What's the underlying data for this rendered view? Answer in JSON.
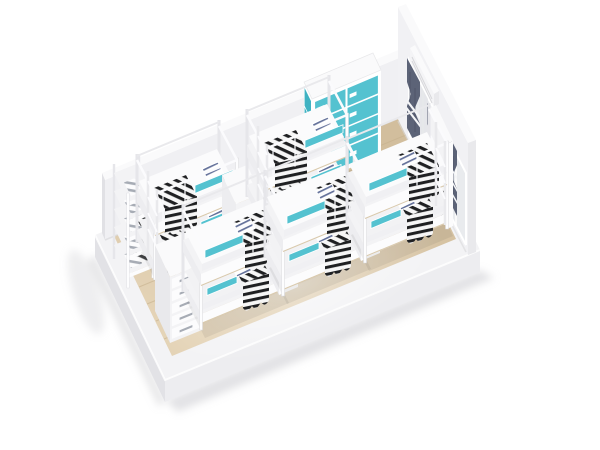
{
  "scene": {
    "title": "Dormitory room - isometric 3D render",
    "description": "Isometric 3D render of a white dormitory room displayed on a white plinth: two rows of white metal bunk beds with black-and-white striped blankets, navy striped pillows and teal safety rails, a teal-door locker cabinet, two windows with dark blue-grey tied curtains, a wall air conditioner, ladder shelf with folded bedding, a drawer rack, bedside cube shelves and a light wood plank floor."
  },
  "colors": {
    "bg": "#ffffff",
    "plinth-top": "#f3f3f5",
    "plinth-left": "#e2e2e6",
    "plinth-right": "#ededf0",
    "ground-shadow": "#c8c8cd",
    "floor-light": "#e4d3b6",
    "floor-dark": "#d2be9d",
    "plank": "#c6b18d",
    "wall-face": "#f1f1f4",
    "wall-cap": "#fafafb",
    "wall-end": "#e9e9ec",
    "lowwall-face": "#f0f0f3",
    "lowwall-end": "#e1e1e5",
    "baseboard": "#d8d8db",
    "glass": "#e9ebee",
    "sheer": "#e4e5e9",
    "curtain": "#5c6377",
    "curtain-deep": "#4a5164",
    "tie-white": "#f4f5f7",
    "ac-body": "#f4f4f6",
    "teal": "#54c2d0",
    "teal-dark": "#3fb2c2",
    "slab": "#f3f3f5",
    "fascia": "#fcfcfd",
    "fascia-end": "#ededf0",
    "mattress-top": "#fbfbfc",
    "mattress-low": "#f2f2f4",
    "mattress-side": "#f0f0f3",
    "wood-line": "#d9c9ac",
    "post": "#fdfdfe",
    "post-back": "#e6e6ea",
    "rail": "#fbfbfd",
    "blanket-ink": "#1f2022",
    "blanket-paper": "#f6f6f6",
    "pillow-stripe": "#64719a",
    "item-stripe": "#a7acb5",
    "shadow-tint": "#1a1a1e"
  },
  "room": {
    "base": {
      "label": "white display plinth"
    },
    "floor": {
      "label": "light wood plank floor",
      "planks": 7
    },
    "walls": {
      "back_wall": "low white wall",
      "right_wall": "tall white wall"
    }
  },
  "furniture": {
    "bunk_beds": {
      "total": 5,
      "back_row_count": 2,
      "front_row_count": 3,
      "frame": "white metal",
      "accent": "teal safety rails",
      "bedding": "white mattresses, black-and-white striped blankets, navy striped pillows",
      "ladders": "white end ladders"
    },
    "locker_cabinet": {
      "front_doors": 8,
      "side_doors": 4,
      "door_color_key": "teal",
      "body": "white"
    },
    "ladder_shelf": {
      "shelves": 5,
      "contents": "striped folded bedding"
    },
    "cubby_shelf": {
      "compartments": 2
    },
    "drawer_rack": {
      "drawers": 5
    },
    "bedside_cubes": 2,
    "headboard_shelf": {
      "slats": 3
    }
  },
  "window_area": {
    "windows": 2,
    "curtains": {
      "dark_panels": 3,
      "sheer_panels": 1,
      "tie_bands": "white"
    },
    "air_conditioner": 1
  }
}
